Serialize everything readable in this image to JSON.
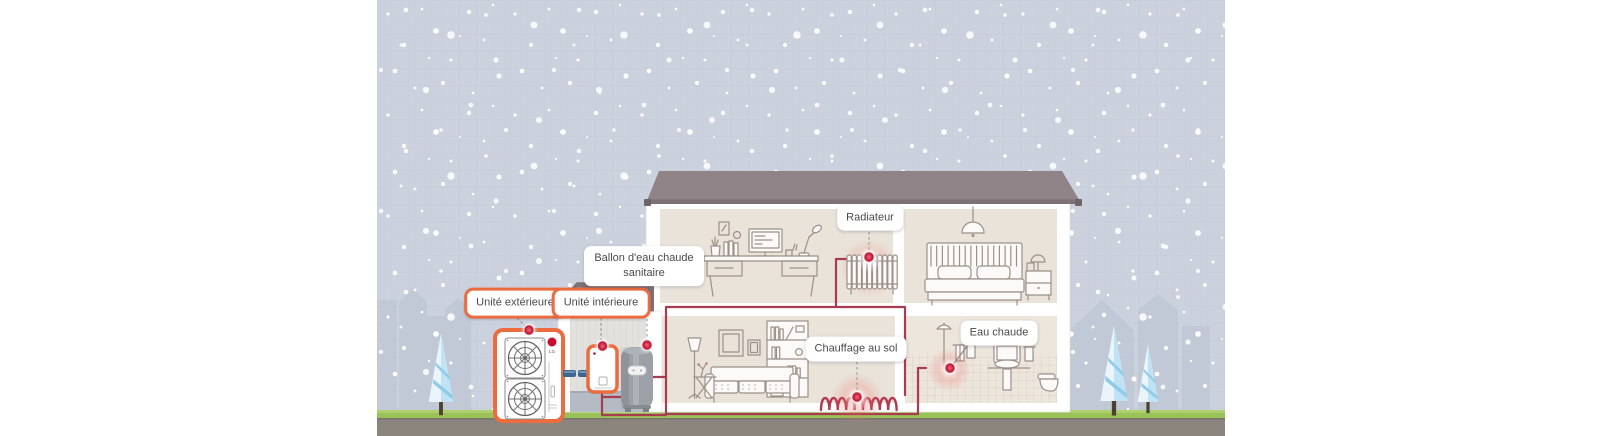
{
  "scene": {
    "brand_logo": "LG"
  },
  "callouts": {
    "outdoor_unit": "Unité extérieure",
    "indoor_unit": "Unité intérieure",
    "dhw_tank": "Ballon d'eau chaude sanitaire",
    "radiator": "Radiateur",
    "floor_heating": "Chauffage au sol",
    "hot_water": "Eau chaude"
  },
  "colors": {
    "accent_orange": "#EC6B3F",
    "indicator_red": "#C8102E",
    "pipe_red": "#A73B4F",
    "pipe_blue": "#3A6690",
    "sky": "#CCD2DD",
    "grass": "#9AC258",
    "ground": "#8B857E",
    "roof": "#8F8387",
    "interior_wall": "#E9E3DA"
  }
}
